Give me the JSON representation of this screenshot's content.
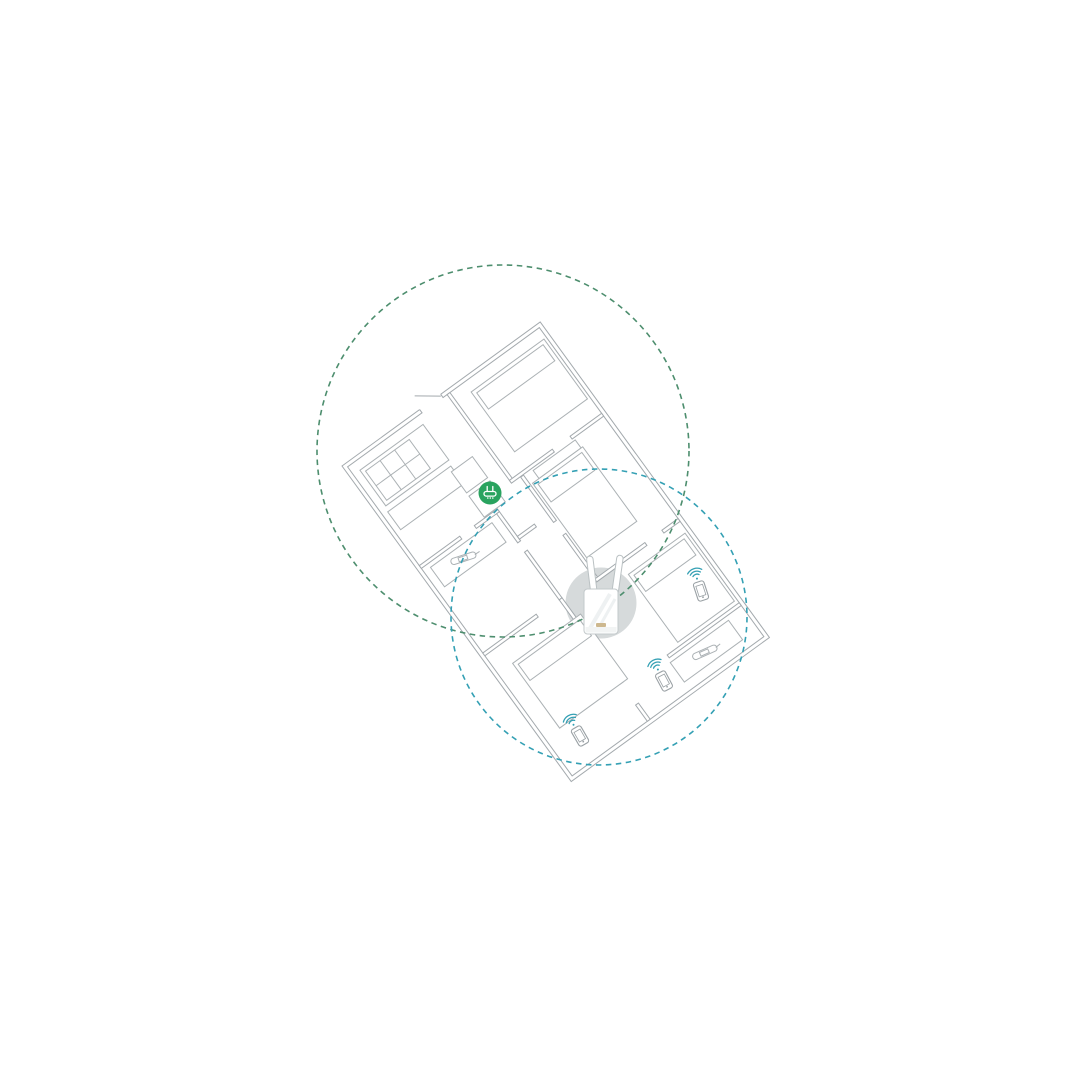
{
  "palette": {
    "background": "#ffffff",
    "wall": "#a3a9ad",
    "furniture": "#abb1b4",
    "routerZone": "#4d8e6e",
    "extZone": "#34a0b4",
    "routerIcon": "#29a35f",
    "highlight": "#d6dadb",
    "deviceOutline": "#c3c9cb",
    "antennaOutline": "#bac1c3",
    "logo": "#cdb88f",
    "phone": "#9aa1a5"
  },
  "zones": {
    "router": {
      "cx": 503,
      "cy": 451,
      "r": 186,
      "style": "dashed",
      "meaning": "router-wifi-coverage"
    },
    "extender": {
      "cx": 599,
      "cy": 617,
      "r": 148,
      "style": "dashed",
      "meaning": "extender-wifi-coverage"
    }
  },
  "devices": {
    "router": {
      "label": "wifi-router",
      "position": {
        "x": 490,
        "y": 493
      }
    },
    "extender": {
      "label": "wifi-range-extender",
      "antennas": 2,
      "position": {
        "x": 601,
        "y": 603
      }
    },
    "phones": [
      {
        "label": "smartphone",
        "position": {
          "x": 701,
          "y": 591
        }
      },
      {
        "label": "smartphone",
        "position": {
          "x": 664,
          "y": 681
        }
      },
      {
        "label": "smartphone",
        "position": {
          "x": 580,
          "y": 736
        }
      }
    ]
  },
  "floor_plan": {
    "rotation_deg": -36,
    "origin": {
      "x": 342,
      "y": 466
    },
    "width": 245,
    "height": 390,
    "rooms": [
      "top-bedroom",
      "kitchen",
      "hallway",
      "middle-left-room",
      "right-bedroom-upper",
      "right-bedroom-lower",
      "bottom-left-bedroom",
      "desk-room"
    ]
  }
}
